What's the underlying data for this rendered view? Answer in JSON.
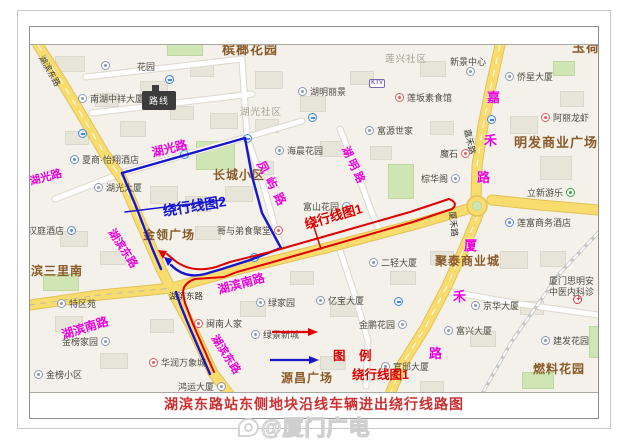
{
  "frame": {
    "caption": "湖滨东路站东侧地块沿线车辆进出绕行线路图",
    "watermark": "@厦门广电",
    "tooltip": "路线"
  },
  "legend": {
    "title": "图 例",
    "items": [
      {
        "label": "绕行线图1",
        "color": "#e10000"
      },
      {
        "label": "绕行线图2",
        "color": "#1616cf"
      }
    ]
  },
  "routes": [
    {
      "id": "route1",
      "label": "绕行线图1",
      "color": "#e10000"
    },
    {
      "id": "route2",
      "label": "绕行线图2",
      "color": "#1616cf"
    }
  ],
  "map": {
    "labels": [
      {
        "t": "槟榔花园",
        "x": 222,
        "y": 42,
        "cls": "district",
        "size": 13
      },
      {
        "t": "玉荷",
        "x": 572,
        "y": 40,
        "cls": "district",
        "size": 13
      },
      {
        "t": "明发商业广场",
        "x": 514,
        "y": 135,
        "cls": "district",
        "size": 13
      },
      {
        "t": "长城小区",
        "x": 213,
        "y": 168,
        "cls": "district"
      },
      {
        "t": "金领广场",
        "x": 143,
        "y": 228,
        "cls": "district"
      },
      {
        "t": "滨三里南",
        "x": 31,
        "y": 264,
        "cls": "district"
      },
      {
        "t": "聚泰商业城",
        "x": 435,
        "y": 254,
        "cls": "district"
      },
      {
        "t": "源昌广场",
        "x": 281,
        "y": 371,
        "cls": "district"
      },
      {
        "t": "燃料花园",
        "x": 533,
        "y": 362,
        "cls": "district"
      },
      {
        "t": "湖光社区",
        "x": 240,
        "y": 107,
        "cls": "area"
      },
      {
        "t": "莲兴社区",
        "x": 385,
        "y": 54,
        "cls": "area"
      },
      {
        "t": "湖光路",
        "x": 30,
        "y": 176,
        "cls": "pink",
        "rot": -15
      },
      {
        "t": "湖光路",
        "x": 152,
        "y": 146,
        "cls": "pink",
        "rot": -14,
        "size": 12
      },
      {
        "t": "湖滨东路",
        "x": 110,
        "y": 224,
        "cls": "pink",
        "rot": 57
      },
      {
        "t": "湖滨东路",
        "x": 213,
        "y": 330,
        "cls": "pink",
        "rot": 57
      },
      {
        "t": "湖滨南路",
        "x": 62,
        "y": 328,
        "cls": "pink",
        "rot": -17,
        "size": 12
      },
      {
        "t": "湖滨南路",
        "x": 218,
        "y": 283,
        "cls": "pink",
        "rot": -15,
        "size": 12
      },
      {
        "t": "凤屿路",
        "x": 260,
        "y": 155,
        "cls": "pink",
        "rot": 62,
        "ls": 6,
        "size": 12
      },
      {
        "t": "湖明路",
        "x": 344,
        "y": 141,
        "cls": "pink",
        "rot": 65,
        "ls": 3
      },
      {
        "t": "嘉",
        "x": 487,
        "y": 90,
        "cls": "pink",
        "size": 13
      },
      {
        "t": "禾",
        "x": 484,
        "y": 133,
        "cls": "pink",
        "size": 13
      },
      {
        "t": "路",
        "x": 477,
        "y": 170,
        "cls": "pink",
        "size": 13
      },
      {
        "t": "厦",
        "x": 464,
        "y": 238,
        "cls": "pink",
        "size": 13
      },
      {
        "t": "禾",
        "x": 453,
        "y": 289,
        "cls": "pink",
        "size": 13
      },
      {
        "t": "路",
        "x": 429,
        "y": 346,
        "cls": "pink",
        "size": 13
      },
      {
        "t": "湖滨东路",
        "x": 41,
        "y": 51,
        "cls": "roadblack",
        "rot": 60
      },
      {
        "t": "湖滨东路",
        "x": 169,
        "y": 291,
        "cls": "roadblack"
      },
      {
        "t": "嘉禾路",
        "x": 467,
        "y": 124,
        "cls": "roadblack",
        "rot": 78
      },
      {
        "t": "厦禾路",
        "x": 452,
        "y": 206,
        "cls": "roadblack",
        "rot": 84
      },
      {
        "t": "绕行线图1",
        "x": 305,
        "y": 217,
        "cls": "route1",
        "rot": -16,
        "size": 13
      },
      {
        "t": "绕行线图2",
        "x": 163,
        "y": 203,
        "cls": "route2",
        "rot": -9,
        "size": 14
      },
      {
        "t": "花园",
        "x": 137,
        "y": 62,
        "cls": "poi"
      }
    ],
    "pois": [
      {
        "t": "南湖中祥大厦",
        "x": 90,
        "y": 94,
        "icon": "building"
      },
      {
        "t": "夏商·怡翔酒店",
        "x": 82,
        "y": 155,
        "icon": "hotel"
      },
      {
        "t": "湖光大厦",
        "x": 106,
        "y": 183,
        "icon": "building"
      },
      {
        "t": "湖明丽景",
        "x": 310,
        "y": 87,
        "icon": "building"
      },
      {
        "t": "莲坂素食馆",
        "x": 407,
        "y": 93,
        "icon": "food"
      },
      {
        "t": "富源世家",
        "x": 377,
        "y": 126,
        "icon": "building"
      },
      {
        "t": "新景中心",
        "x": 450,
        "y": 57
      },
      {
        "t": "侨星大厦",
        "x": 517,
        "y": 72,
        "icon": "building"
      },
      {
        "t": "阿丽龙虾",
        "x": 553,
        "y": 113,
        "icon": "food"
      },
      {
        "t": "魔石",
        "x": 440,
        "y": 149,
        "icon": "food",
        "side": "right"
      },
      {
        "t": "棕华阁",
        "x": 421,
        "y": 174,
        "icon": "building",
        "side": "right"
      },
      {
        "t": "立新游乐",
        "x": 527,
        "y": 188,
        "icon": "green",
        "side": "right"
      },
      {
        "t": "莲富商务酒店",
        "x": 517,
        "y": 218,
        "icon": "hotel"
      },
      {
        "t": "海晨花园",
        "x": 287,
        "y": 146,
        "icon": "building"
      },
      {
        "t": "富山花园",
        "x": 303,
        "y": 202,
        "icon": "building",
        "side": "right"
      },
      {
        "t": "哥与弟食聚堂",
        "x": 217,
        "y": 226,
        "icon": "food",
        "side": "right"
      },
      {
        "t": "汉庭酒店",
        "x": 28,
        "y": 226,
        "icon": "hotel",
        "side": "right"
      },
      {
        "t": "特区苑",
        "x": 69,
        "y": 299,
        "icon": "building"
      },
      {
        "t": "金榜家园",
        "x": 62,
        "y": 337,
        "icon": "building",
        "side": "right"
      },
      {
        "t": "金榜小区",
        "x": 46,
        "y": 370,
        "icon": "building"
      },
      {
        "t": "华润万象城",
        "x": 161,
        "y": 358,
        "icon": "food"
      },
      {
        "t": "闽南人家",
        "x": 206,
        "y": 319,
        "icon": "food"
      },
      {
        "t": "绿家园",
        "x": 268,
        "y": 298,
        "icon": "building"
      },
      {
        "t": "绿景新城",
        "x": 263,
        "y": 330,
        "icon": "building"
      },
      {
        "t": "亿宝大厦",
        "x": 328,
        "y": 296,
        "icon": "building"
      },
      {
        "t": "二轻大厦",
        "x": 381,
        "y": 258,
        "icon": "building"
      },
      {
        "t": "京华大厦",
        "x": 483,
        "y": 301,
        "icon": "building"
      },
      {
        "t": "金鹏花园",
        "x": 359,
        "y": 320,
        "icon": "building",
        "side": "right"
      },
      {
        "t": "富兴大厦",
        "x": 456,
        "y": 326,
        "icon": "building"
      },
      {
        "t": "建发花园",
        "x": 553,
        "y": 336,
        "icon": "building"
      },
      {
        "t": "官邸大厦",
        "x": 393,
        "y": 362,
        "icon": "building"
      },
      {
        "t": "鸿运大厦",
        "x": 178,
        "y": 382,
        "icon": "building",
        "side": "right"
      },
      {
        "t": "厦门思明安",
        "x": 549,
        "y": 276
      },
      {
        "t": "中医内科诊",
        "x": 549,
        "y": 287
      }
    ],
    "standalone_icons": [
      {
        "x": 78,
        "y": 128,
        "type": "bus"
      },
      {
        "x": 165,
        "y": 74,
        "type": "bus"
      },
      {
        "x": 180,
        "y": 149,
        "type": "bus"
      },
      {
        "x": 243,
        "y": 133,
        "type": "bus"
      },
      {
        "x": 250,
        "y": 252,
        "type": "bus"
      },
      {
        "x": 308,
        "y": 112,
        "type": "bus"
      },
      {
        "x": 394,
        "y": 296,
        "type": "bus"
      },
      {
        "x": 487,
        "y": 114,
        "type": "bus"
      },
      {
        "x": 466,
        "y": 66,
        "type": "building"
      },
      {
        "x": 101,
        "y": 60,
        "type": "building"
      },
      {
        "x": 573,
        "y": 294,
        "type": "cross"
      }
    ],
    "ktv_badge": {
      "t": "KTV",
      "x": 369,
      "y": 78
    }
  }
}
